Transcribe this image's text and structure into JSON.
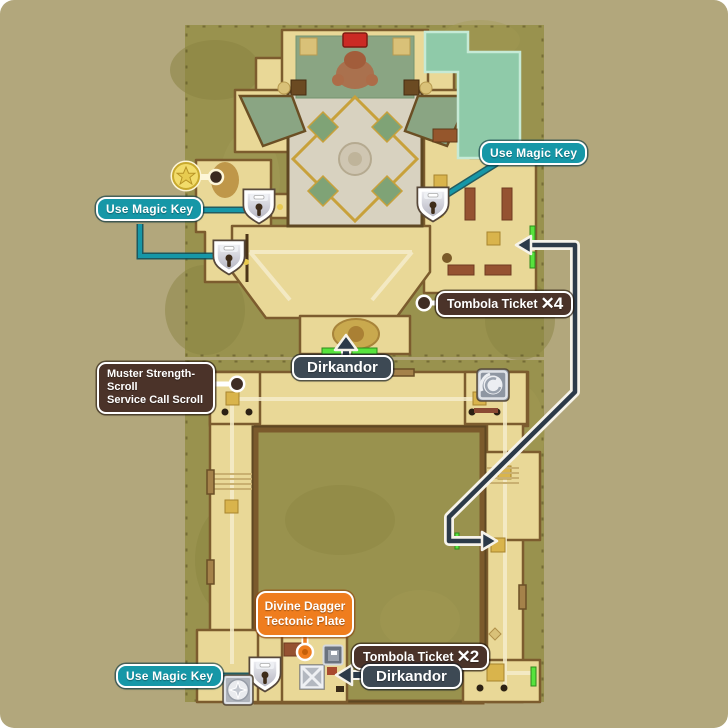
{
  "labels": {
    "use_magic_key_left": {
      "text": "Use Magic Key"
    },
    "use_magic_key_right": {
      "text": "Use Magic Key"
    },
    "use_magic_key_south": {
      "text": "Use Magic Key"
    },
    "tombola_upper": {
      "text": "Tombola Ticket",
      "count": "✕4"
    },
    "tombola_lower": {
      "text": "Tombola Ticket",
      "count": "✕2"
    },
    "dirkandor_north": {
      "text": "Dirkandor"
    },
    "dirkandor_south": {
      "text": "Dirkandor"
    },
    "muster_scrolls": {
      "text": "Muster Strength-\nScroll\nService Call Scroll"
    },
    "divine_dagger": {
      "text": "Divine Dagger\nTectonic Plate"
    }
  },
  "icons": {
    "mini_medal": "gold star coin",
    "lock": "padlock shield (locked door)",
    "spiral_portal": "gray tile with white spiral",
    "compass_crest": "gray tile with compass circle",
    "crate": "crate with X straps",
    "door_tile": "small door tile",
    "exit_marker": "bright green bar",
    "route_arrow": "navy arrow with white outline"
  },
  "colors": {
    "background": "#b2a77c",
    "field": "#99924e",
    "floor": "#e9d897",
    "teal_label": "#1697a7",
    "brown_label": "#4b3329",
    "slate_label": "#3d4954",
    "orange_label": "#ef7d1e",
    "route_arrow": "#2c3a49",
    "exit_marker": "#57e33d",
    "jade_area": "#8fcaa9",
    "carpet_green": "#8aa583"
  }
}
